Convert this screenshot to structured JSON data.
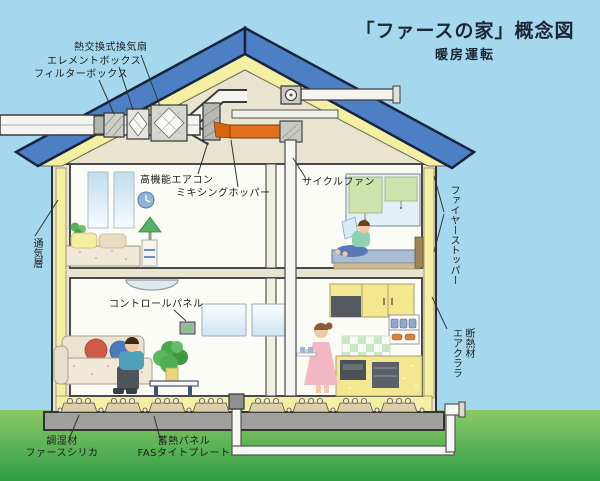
{
  "title": {
    "main": "「ファースの家」概念図",
    "sub": "暖房運転"
  },
  "labels": {
    "heat_exchange_fan": "熱交換式換気扇",
    "element_box": "エレメントボックス",
    "filter_box": "フィルターボックス",
    "high_performance_aircon": "高機能エアコン",
    "mixing_hopper": "ミキシングホッパー",
    "cycle_fan": "サイクルファン",
    "control_panel": "コントロールパネル",
    "ventilation_layer": "通気層",
    "fire_stopper": "ファイヤーストッパー",
    "insulation": "断熱材\nエアクララ",
    "humidity_material": "調湿材\nファースシリカ",
    "heat_storage_panel": "蓄熱パネル\nFASタイトプレート"
  },
  "colors": {
    "sky": "#a5d8ee",
    "roof_blue": "#4c7fc4",
    "roof_outline": "#18243d",
    "insulation_yellow": "#f4efa3",
    "structure_beige": "#e9e4d0",
    "room_white": "#fcfcf7",
    "duct_orange": "#e2711d",
    "foundation_grey": "#a0a09c",
    "grass_top": "#8cc968",
    "grass_bottom": "#2f9d45"
  }
}
